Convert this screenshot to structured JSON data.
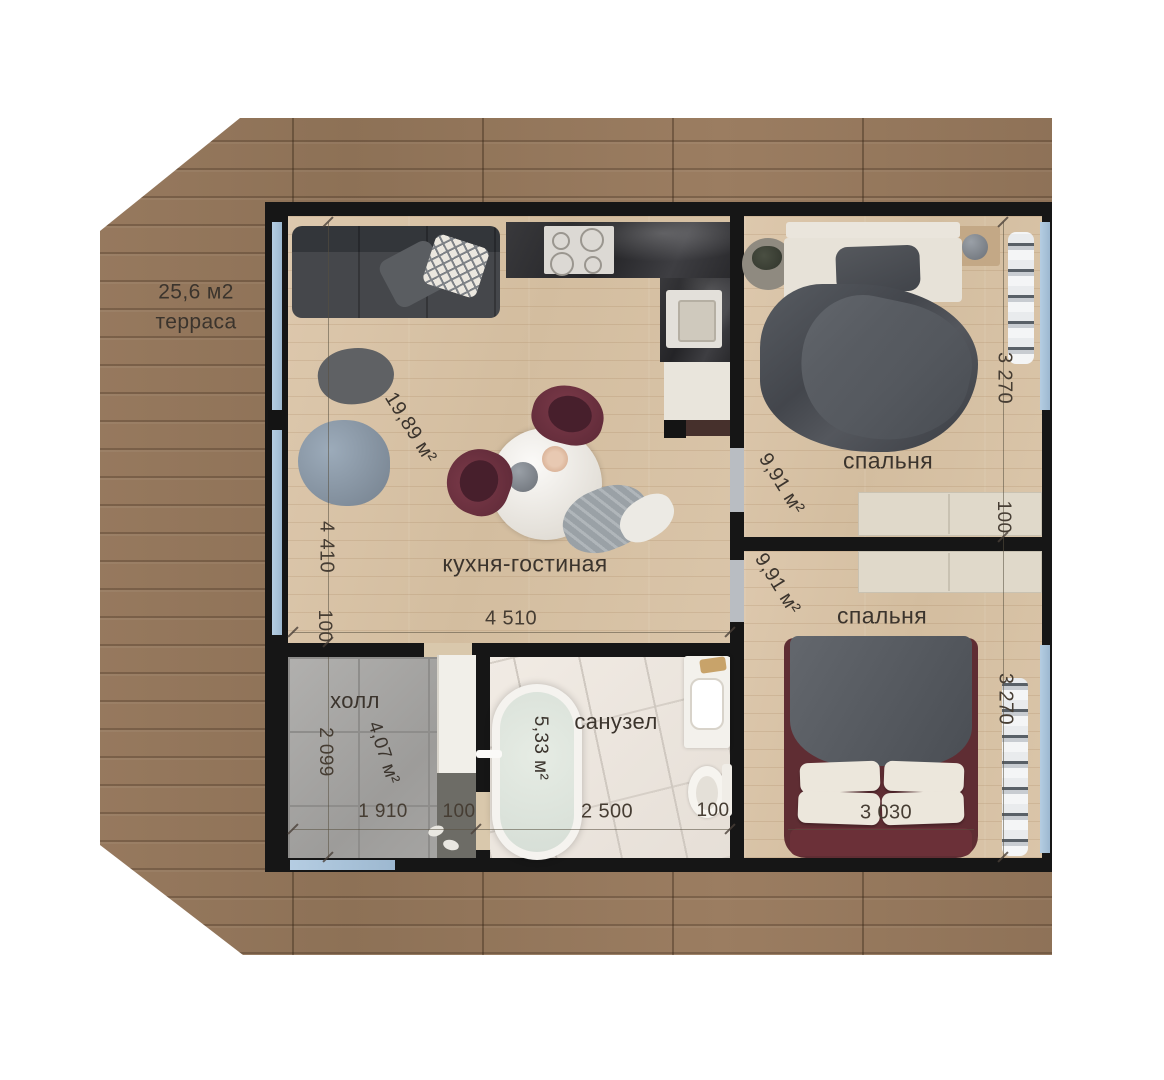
{
  "terrace": {
    "area": "25,6 м2",
    "name": "терраса"
  },
  "rooms": {
    "kitchen": {
      "name": "кухня-гостиная",
      "area": "19,89 м²"
    },
    "bedroom1": {
      "name": "спальня",
      "area": "9,91 м²"
    },
    "bedroom2": {
      "name": "спальня",
      "area": "9,91 м²"
    },
    "hall": {
      "name": "холл",
      "area": "4,07 м²"
    },
    "bathroom": {
      "name": "санузел",
      "area": "5,33 м²"
    }
  },
  "dimensions": {
    "living_height": "4 410",
    "living_wall_bottom": "100",
    "living_width": "4 510",
    "bedroom1_height": "3 270",
    "bedrooms_wall": "100",
    "bedroom2_height": "3 270",
    "bed_width": "3 030",
    "hall_height": "2 099",
    "hall_width": "1 910",
    "hall_wall": "100",
    "bathroom_width": "2 500",
    "bathroom_wall": "100"
  },
  "colors": {
    "background": "#ffffff",
    "deck_wood": "#97795e",
    "floor_wood": "#d8c3a8",
    "wall": "#161616",
    "glass": "#a9c3d9",
    "hall_tile": "#a6a5a2",
    "bath_tile": "#ece6df",
    "text": "#3b342d",
    "accent_burgundy": "#6e3340"
  }
}
